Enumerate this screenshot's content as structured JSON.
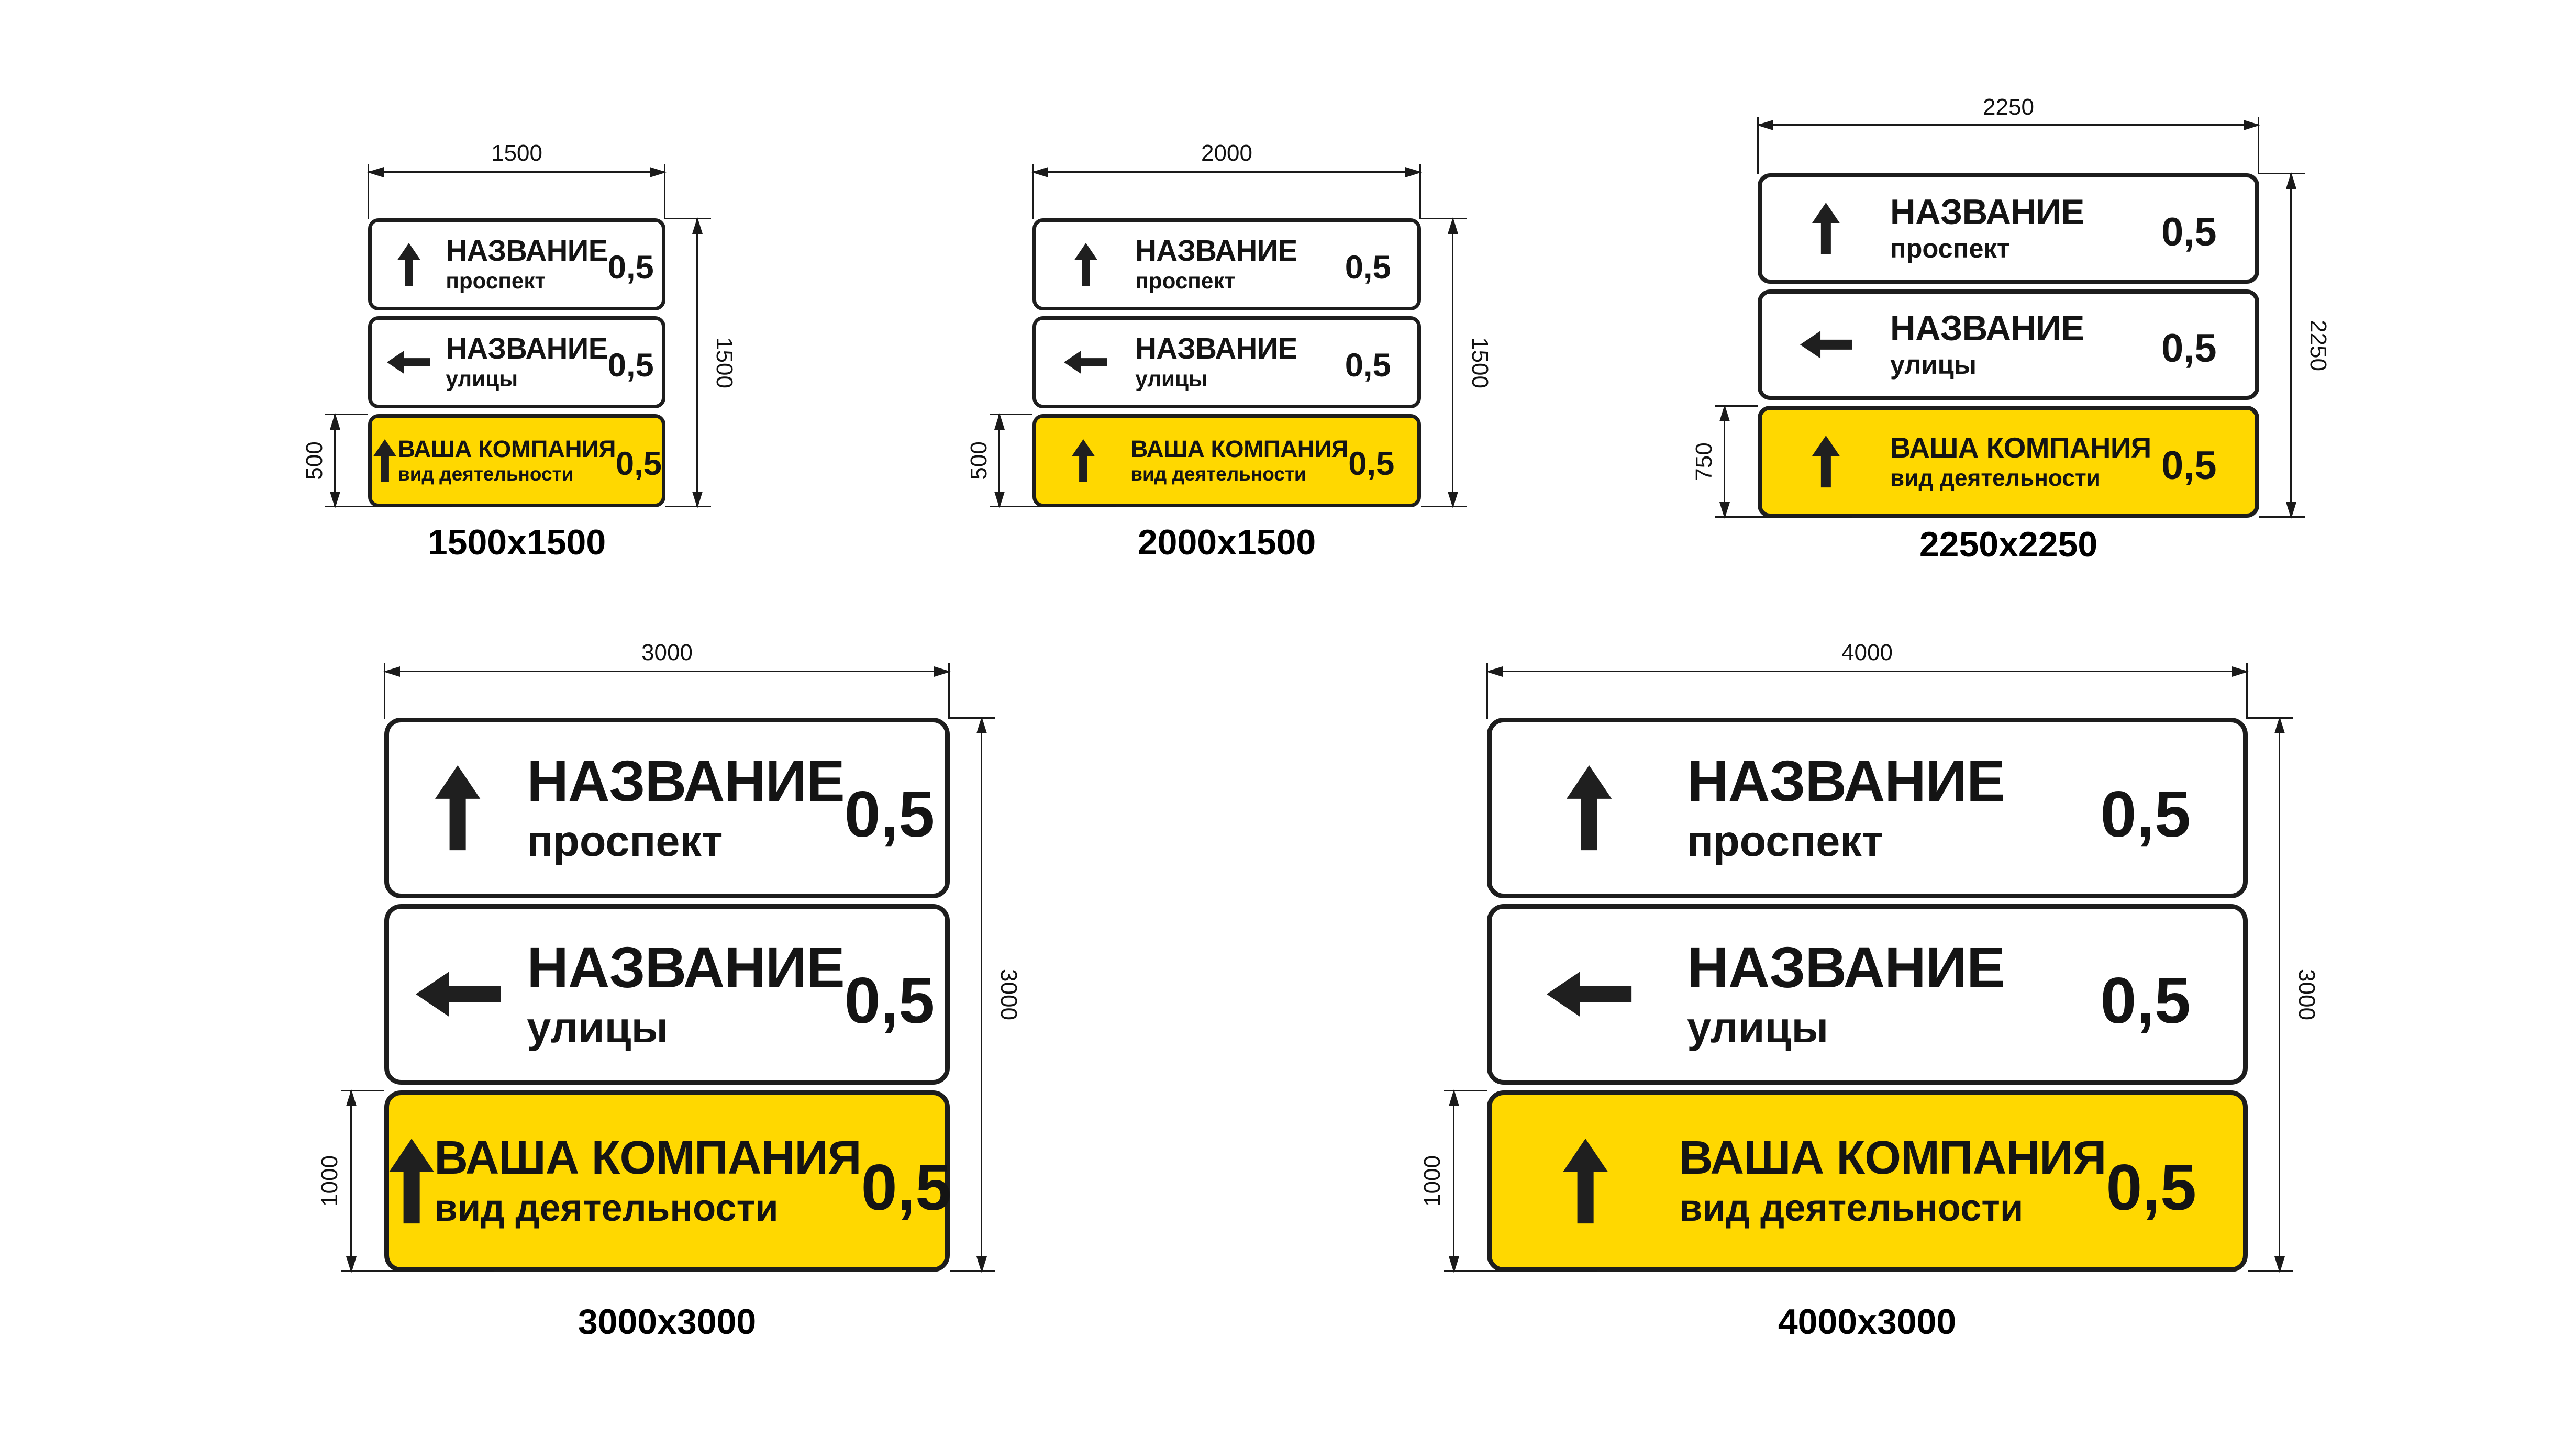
{
  "colors": {
    "background": "#ffffff",
    "panel_border": "#1d1d1d",
    "panel_white": "#ffffff",
    "panel_yellow": "#ffd800",
    "text": "#141414",
    "dimension_lines": "#1a1a1a"
  },
  "signs": [
    {
      "caption": "1500x1500",
      "dims": {
        "width": "1500",
        "height": "1500",
        "bottom_panel": "500"
      },
      "panels": [
        {
          "icon": "up-arrow",
          "title": "НАЗВАНИЕ",
          "subtitle": "проспект",
          "distance": "0,5",
          "background": "white"
        },
        {
          "icon": "left-arrow",
          "title": "НАЗВАНИЕ",
          "subtitle": "улицы",
          "distance": "0,5",
          "background": "white"
        },
        {
          "icon": "up-arrow",
          "title": "ВАША КОМПАНИЯ",
          "subtitle": "вид деятельности",
          "distance": "0,5",
          "background": "yellow"
        }
      ]
    },
    {
      "caption": "2000x1500",
      "dims": {
        "width": "2000",
        "height": "1500",
        "bottom_panel": "500"
      },
      "panels": [
        {
          "icon": "up-arrow",
          "title": "НАЗВАНИЕ",
          "subtitle": "проспект",
          "distance": "0,5",
          "background": "white"
        },
        {
          "icon": "left-arrow",
          "title": "НАЗВАНИЕ",
          "subtitle": "улицы",
          "distance": "0,5",
          "background": "white"
        },
        {
          "icon": "up-arrow",
          "title": "ВАША КОМПАНИЯ",
          "subtitle": "вид деятельности",
          "distance": "0,5",
          "background": "yellow"
        }
      ]
    },
    {
      "caption": "2250x2250",
      "dims": {
        "width": "2250",
        "height": "2250",
        "bottom_panel": "750"
      },
      "panels": [
        {
          "icon": "up-arrow",
          "title": "НАЗВАНИЕ",
          "subtitle": "проспект",
          "distance": "0,5",
          "background": "white"
        },
        {
          "icon": "left-arrow",
          "title": "НАЗВАНИЕ",
          "subtitle": "улицы",
          "distance": "0,5",
          "background": "white"
        },
        {
          "icon": "up-arrow",
          "title": "ВАША КОМПАНИЯ",
          "subtitle": "вид деятельности",
          "distance": "0,5",
          "background": "yellow"
        }
      ]
    },
    {
      "caption": "3000x3000",
      "dims": {
        "width": "3000",
        "height": "3000",
        "bottom_panel": "1000"
      },
      "panels": [
        {
          "icon": "up-arrow",
          "title": "НАЗВАНИЕ",
          "subtitle": "проспект",
          "distance": "0,5",
          "background": "white"
        },
        {
          "icon": "left-arrow",
          "title": "НАЗВАНИЕ",
          "subtitle": "улицы",
          "distance": "0,5",
          "background": "white"
        },
        {
          "icon": "up-arrow",
          "title": "ВАША КОМПАНИЯ",
          "subtitle": "вид деятельности",
          "distance": "0,5",
          "background": "yellow"
        }
      ]
    },
    {
      "caption": "4000x3000",
      "dims": {
        "width": "4000",
        "height": "3000",
        "bottom_panel": "1000"
      },
      "panels": [
        {
          "icon": "up-arrow",
          "title": "НАЗВАНИЕ",
          "subtitle": "проспект",
          "distance": "0,5",
          "background": "white"
        },
        {
          "icon": "left-arrow",
          "title": "НАЗВАНИЕ",
          "subtitle": "улицы",
          "distance": "0,5",
          "background": "white"
        },
        {
          "icon": "up-arrow",
          "title": "ВАША КОМПАНИЯ",
          "subtitle": "вид деятельности",
          "distance": "0,5",
          "background": "yellow"
        }
      ]
    }
  ]
}
